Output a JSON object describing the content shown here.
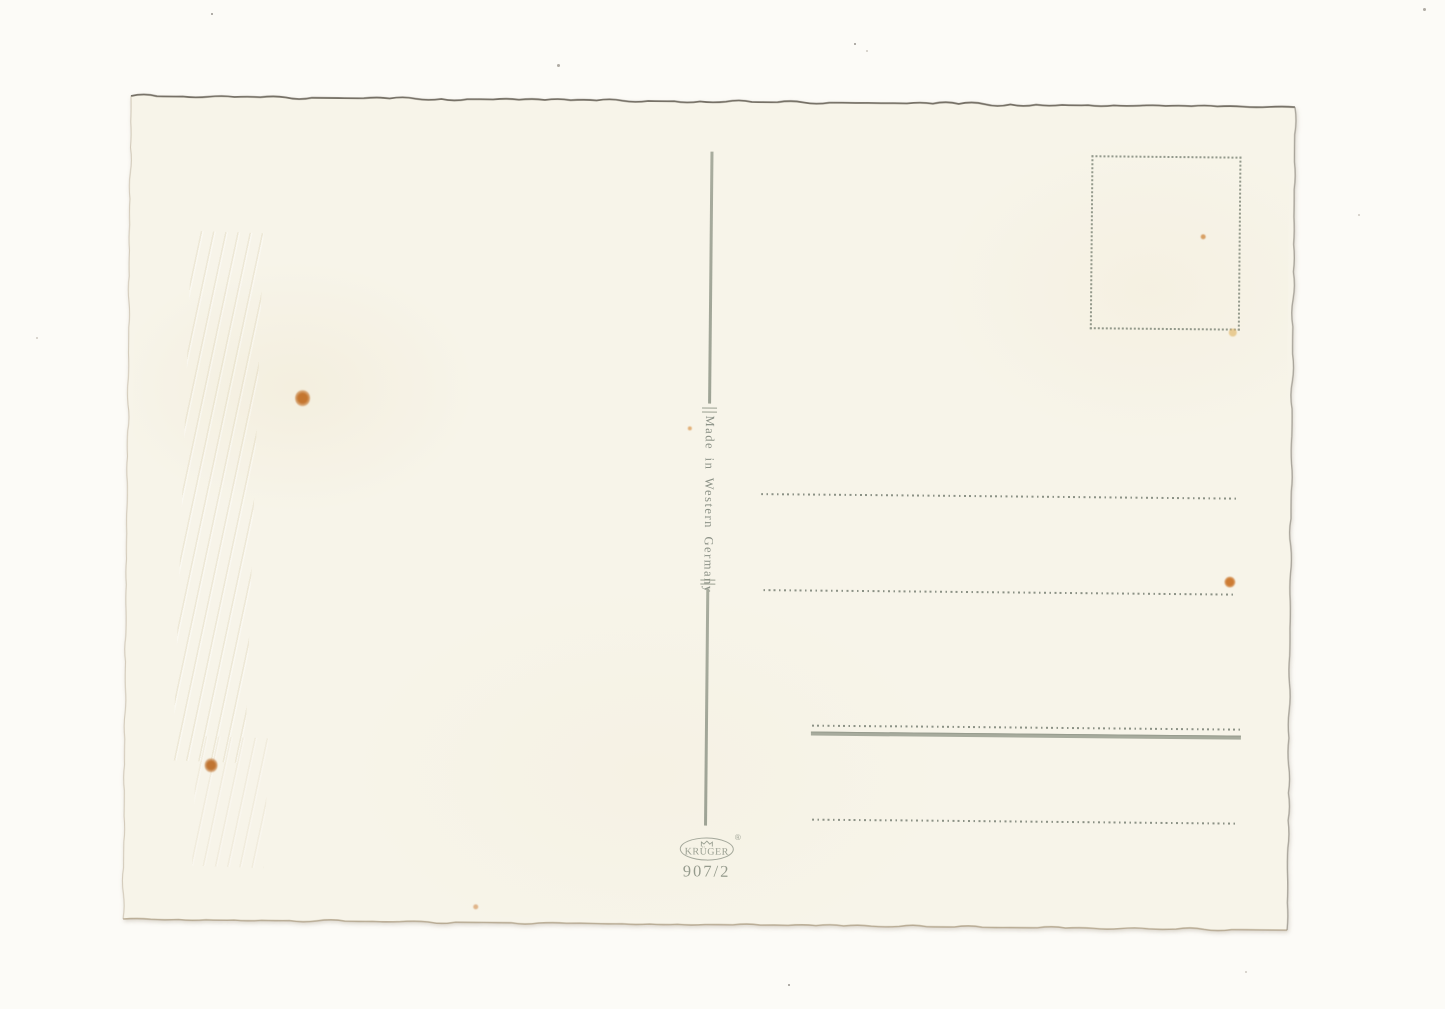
{
  "postcard": {
    "origin_label": "Made in Western Germany",
    "publisher": {
      "name": "KRÜGER",
      "registered_symbol": "®",
      "series_number": "907/2"
    },
    "colors": {
      "scan_background": "#fcfbf7",
      "paper": "#f7f4e9",
      "print_gray_green": "#8d9288",
      "rule_gray_green": "#a7ab9d",
      "foxing_orange": "#c97a35",
      "top_edge_shadow": "#5f594f"
    }
  }
}
